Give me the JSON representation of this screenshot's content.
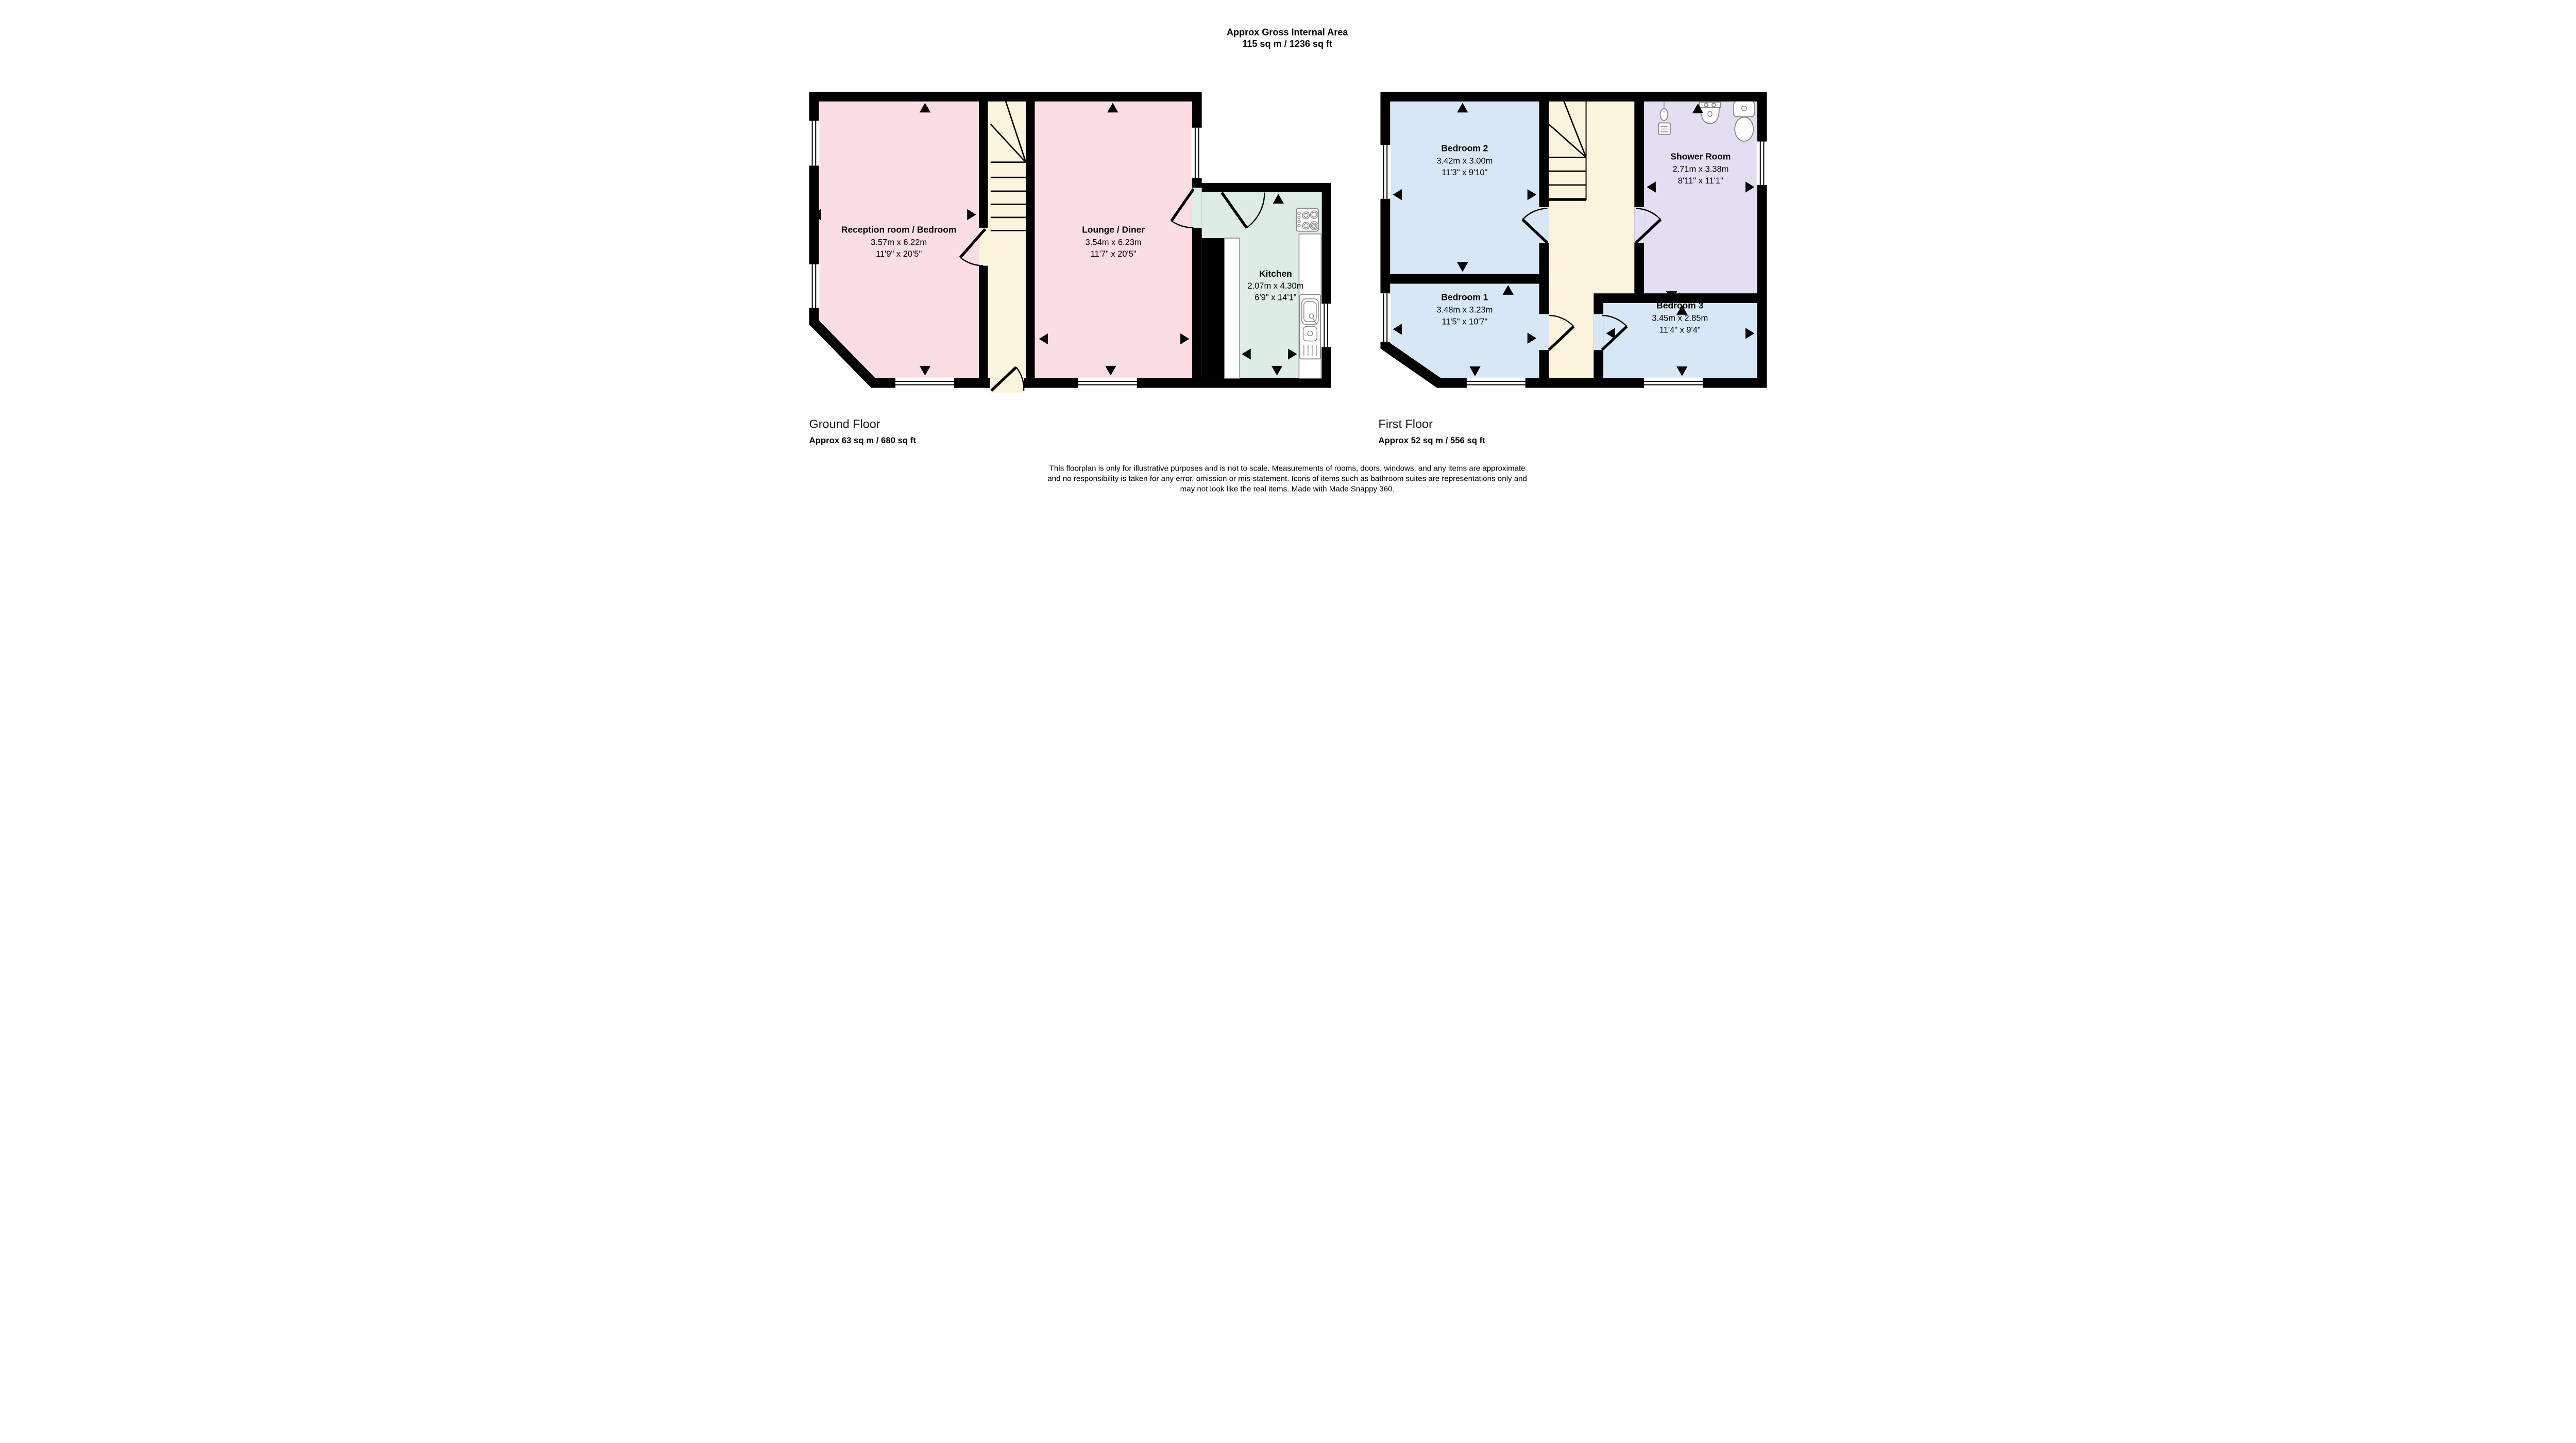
{
  "title": {
    "line1": "Approx Gross Internal Area",
    "line2": "115 sq m / 1236 sq ft"
  },
  "ground_floor": {
    "label": "Ground Floor",
    "area": "Approx 63 sq m / 680 sq ft",
    "rooms": {
      "reception": {
        "name": "Reception room / Bedroom",
        "metric": "3.57m x 6.22m",
        "imperial": "11'9\" x 20'5\""
      },
      "lounge": {
        "name": "Lounge / Diner",
        "metric": "3.54m x 6.23m",
        "imperial": "11'7\" x 20'5\""
      },
      "kitchen": {
        "name": "Kitchen",
        "metric": "2.07m x 4.30m",
        "imperial": "6'9\" x 14'1\""
      }
    }
  },
  "first_floor": {
    "label": "First Floor",
    "area": "Approx 52 sq m / 556 sq ft",
    "rooms": {
      "bedroom2": {
        "name": "Bedroom 2",
        "metric": "3.42m x 3.00m",
        "imperial": "11'3\" x 9'10\""
      },
      "shower": {
        "name": "Shower Room",
        "metric": "2.71m x 3.38m",
        "imperial": "8'11\" x 11'1\""
      },
      "bedroom1": {
        "name": "Bedroom 1",
        "metric": "3.48m x 3.23m",
        "imperial": "11'5\" x 10'7\""
      },
      "bedroom3": {
        "name": "Bedroom 3",
        "metric": "3.45m x 2.85m",
        "imperial": "11'4\" x 9'4\""
      }
    }
  },
  "disclaimer": {
    "line1": "This floorplan is only for illustrative purposes and is not to scale. Measurements of rooms, doors, windows, and any items are approximate",
    "line2": "and no responsibility is taken for any error, omission or mis-statement. Icons of items such as bathroom suites are representations only and",
    "line3": "may not look like the real items. Made with Made Snappy 360."
  },
  "colors": {
    "room_pink": "#fbdee4",
    "hall_cream": "#fcf3dc",
    "kitchen_mint": "#ddece5",
    "bedroom_blue": "#d8e7f6",
    "shower_lavender": "#e4def2",
    "wall": "#000000"
  }
}
